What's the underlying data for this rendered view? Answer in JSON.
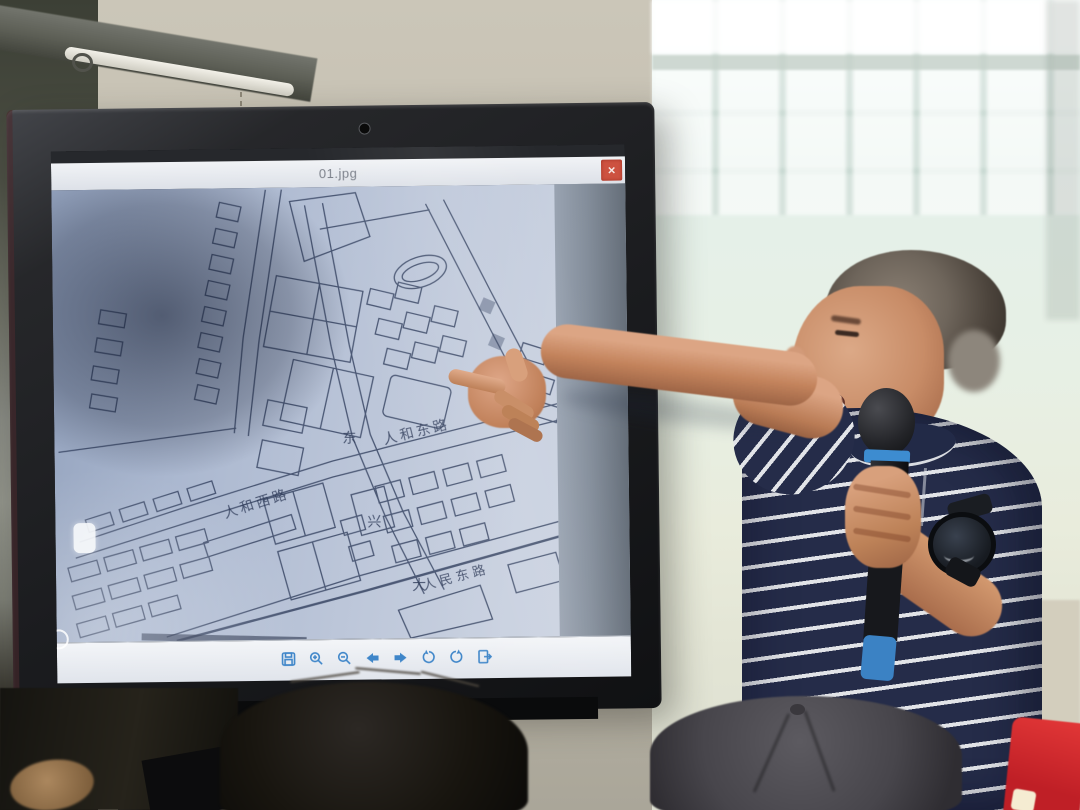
{
  "viewer": {
    "title": "01.jpg",
    "close_glyph": "×",
    "toolbar_titles": [
      "save",
      "zoom-in",
      "zoom-out",
      "previous",
      "next",
      "rotate-left",
      "rotate-right",
      "exit"
    ],
    "colors": {
      "toolbar_icon": "#3f86c9",
      "titlebar_bg": "#e9ebef",
      "close_button": "#cd5240",
      "map_paper": "#bcc6d9",
      "map_ink": "#32405f"
    }
  },
  "map": {
    "labels": {
      "renhe_east_road": "人和东路",
      "renhe_west_road": "人和西路",
      "renmin_east_road": "人民东路",
      "dongxing_char_1": "东",
      "dongxing_char_2": "兴",
      "dongxing_char_3": "大"
    }
  },
  "scene": {
    "colors": {
      "shirt_navy": "#252c49",
      "shirt_stripe": "#e2e4e8",
      "mic_accent_blue": "#3d8cd0",
      "red_garment": "#d42a2e",
      "window_glow": "#eef7f3"
    }
  }
}
